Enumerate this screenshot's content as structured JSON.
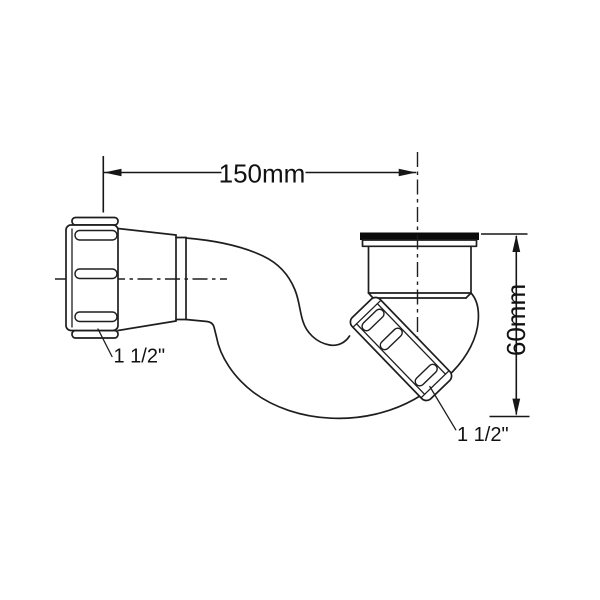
{
  "diagram": {
    "dimensions": {
      "width_label": "150mm",
      "height_label": "60mm"
    },
    "labels": {
      "inlet_size": "1 1/2\"",
      "outlet_size": "1 1/2\""
    },
    "colors": {
      "background": "#ffffff",
      "line": "#1e1e1e",
      "seal_washer": "#0b0b0b",
      "text": "#111111"
    }
  }
}
